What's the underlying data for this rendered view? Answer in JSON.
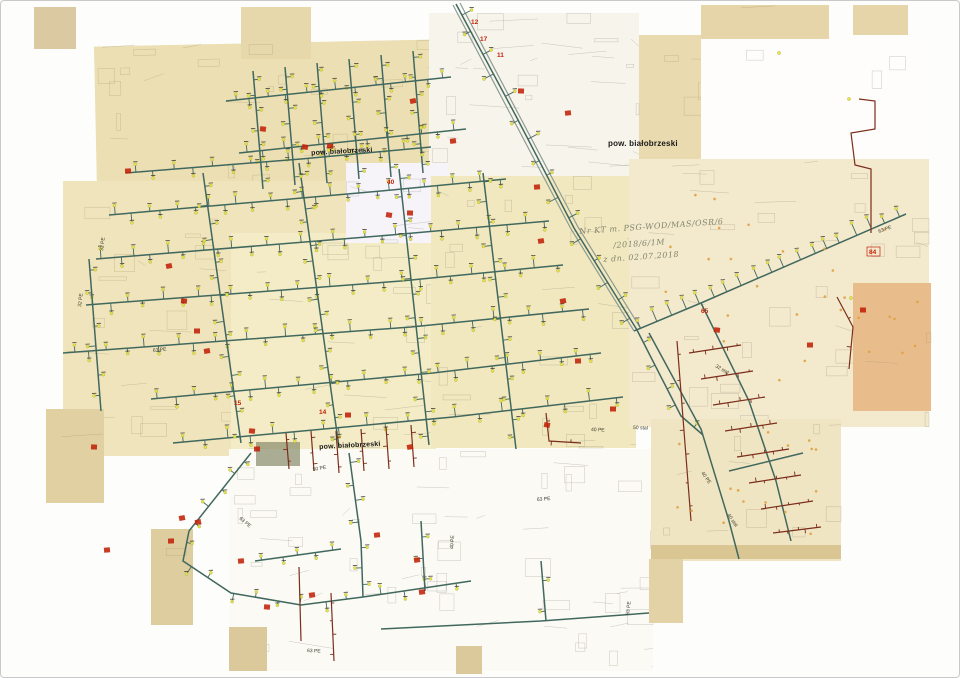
{
  "page": {
    "width": 960,
    "height": 678,
    "border_color": "#c9c9c9",
    "background": "#ffffff"
  },
  "palette": {
    "teal": "#41685e",
    "maroon": "#7b2e1c",
    "red": "#c22108",
    "yellow_dot": "#e8e348",
    "orange_dot": "#dfa13e",
    "road_casing": "#8d9b94",
    "handwriting": "#83856e",
    "print": "#191917",
    "pipe_label": "#3c3c2c"
  },
  "labels": {
    "pow1": {
      "text": "pow. białobrzeski",
      "x": 310,
      "y": 149,
      "fs": 7,
      "r": -3
    },
    "pow2": {
      "text": "pow. białobrzeski",
      "x": 607,
      "y": 138,
      "fs": 8,
      "r": 0
    },
    "pow3": {
      "text": "pow. białobrzeski",
      "x": 318,
      "y": 443,
      "fs": 7,
      "r": -3
    },
    "hw1": {
      "text": "Nr KT m. PSG-WOD/MAS/OSR/6",
      "x": 578,
      "y": 226,
      "fs": 8,
      "r": -4
    },
    "hw2": {
      "text": "/2018/6/1M",
      "x": 612,
      "y": 240,
      "fs": 8,
      "r": -4
    },
    "hw3": {
      "text": "z dn. 02.07.2018",
      "x": 602,
      "y": 254,
      "fs": 8,
      "r": -4
    }
  },
  "sheets": [
    {
      "x": 33,
      "y": 6,
      "w": 42,
      "h": 42,
      "c": "#dbc9a1",
      "dens": 0.4
    },
    {
      "x": 95,
      "y": 42,
      "w": 340,
      "h": 196,
      "c": "#ecdfb4",
      "rot": -1.2,
      "dens": 1
    },
    {
      "x": 240,
      "y": 6,
      "w": 70,
      "h": 52,
      "c": "#e7d8ac",
      "dens": 0.5
    },
    {
      "x": 620,
      "y": 34,
      "w": 90,
      "h": 145,
      "c": "#e9dab0",
      "dens": 0.8
    },
    {
      "x": 700,
      "y": 4,
      "w": 128,
      "h": 36,
      "c": "#e5d5a9",
      "dens": 0.4
    },
    {
      "x": 852,
      "y": 4,
      "w": 55,
      "h": 30,
      "c": "#e5d5a9",
      "dens": 0.3
    },
    {
      "x": 428,
      "y": 12,
      "w": 210,
      "h": 165,
      "c": "#f7f4ec",
      "dens": 2.4
    },
    {
      "x": 700,
      "y": 38,
      "w": 228,
      "h": 128,
      "c": "#fefdfb",
      "dens": 0.4
    },
    {
      "x": 62,
      "y": 180,
      "w": 300,
      "h": 275,
      "c": "#efe4bb",
      "dens": 1.1
    },
    {
      "x": 230,
      "y": 232,
      "w": 205,
      "h": 218,
      "c": "#f3ecc6",
      "dens": 1.2
    },
    {
      "x": 345,
      "y": 162,
      "w": 102,
      "h": 80,
      "c": "#f6f4f8",
      "dens": 1.8
    },
    {
      "x": 430,
      "y": 175,
      "w": 205,
      "h": 272,
      "c": "#f1e8bf",
      "dens": 1.2
    },
    {
      "x": 628,
      "y": 158,
      "w": 300,
      "h": 268,
      "c": "#f3e9cd",
      "dens": 1.1
    },
    {
      "x": 852,
      "y": 282,
      "w": 78,
      "h": 128,
      "c": "#e9bc8c",
      "dens": 0.6
    },
    {
      "x": 45,
      "y": 408,
      "w": 58,
      "h": 94,
      "c": "#e0d0a2",
      "dens": 0.4
    },
    {
      "x": 150,
      "y": 528,
      "w": 42,
      "h": 96,
      "c": "#decd9f",
      "dens": 0.4
    },
    {
      "x": 228,
      "y": 448,
      "w": 424,
      "h": 222,
      "c": "#fbfaf5",
      "dens": 1.5
    },
    {
      "x": 650,
      "y": 418,
      "w": 190,
      "h": 142,
      "c": "#f0e5c2",
      "dens": 1.2
    },
    {
      "x": 650,
      "y": 544,
      "w": 190,
      "h": 14,
      "c": "#d9c693",
      "dens": 0
    },
    {
      "x": 648,
      "y": 558,
      "w": 34,
      "h": 64,
      "c": "#e2d2a6",
      "dens": 0.3
    },
    {
      "x": 228,
      "y": 626,
      "w": 38,
      "h": 44,
      "c": "#dbc89b",
      "dens": 0.3
    },
    {
      "x": 455,
      "y": 645,
      "w": 26,
      "h": 28,
      "c": "#dbc89b",
      "dens": 0.2
    },
    {
      "x": 255,
      "y": 441,
      "w": 44,
      "h": 24,
      "c": "#8f9272",
      "op": 0.75,
      "dens": 0
    }
  ],
  "roads": [
    {
      "p": [
        [
          452,
          4
        ],
        [
          512,
          118
        ],
        [
          570,
          228
        ],
        [
          633,
          330
        ]
      ]
    },
    {
      "p": [
        [
          459,
          2
        ],
        [
          519,
          116
        ],
        [
          577,
          226
        ],
        [
          640,
          328
        ]
      ]
    }
  ],
  "pipes": [
    {
      "p": [
        [
          108,
          214
        ],
        [
          380,
          190
        ],
        [
          505,
          178
        ]
      ],
      "n": 26,
      "len": 7,
      "side": 0
    },
    {
      "p": [
        [
          95,
          258
        ],
        [
          390,
          234
        ],
        [
          548,
          220
        ]
      ],
      "n": 28,
      "len": 7,
      "side": 0
    },
    {
      "p": [
        [
          85,
          304
        ],
        [
          400,
          280
        ],
        [
          562,
          264
        ]
      ],
      "n": 28,
      "len": 7,
      "side": 0
    },
    {
      "p": [
        [
          62,
          352
        ],
        [
          410,
          326
        ],
        [
          588,
          308
        ]
      ],
      "n": 30,
      "len": 7,
      "side": 0
    },
    {
      "p": [
        [
          150,
          398
        ],
        [
          432,
          372
        ],
        [
          600,
          352
        ]
      ],
      "n": 26,
      "len": 7,
      "side": 0
    },
    {
      "p": [
        [
          172,
          442
        ],
        [
          452,
          416
        ],
        [
          622,
          396
        ]
      ],
      "n": 20,
      "len": 7,
      "side": 0
    },
    {
      "p": [
        [
          202,
          172
        ],
        [
          240,
          442
        ]
      ],
      "n": 14,
      "len": 6,
      "side": 0
    },
    {
      "p": [
        [
          298,
          162
        ],
        [
          338,
          446
        ]
      ],
      "n": 16,
      "len": 6,
      "side": 0
    },
    {
      "p": [
        [
          398,
          168
        ],
        [
          428,
          444
        ]
      ],
      "n": 14,
      "len": 6,
      "side": 0
    },
    {
      "p": [
        [
          482,
          172
        ],
        [
          515,
          448
        ]
      ],
      "n": 14,
      "len": 6,
      "side": 0
    },
    {
      "p": [
        [
          252,
          70
        ],
        [
          262,
          188
        ]
      ],
      "n": 7,
      "len": 5,
      "side": 0
    },
    {
      "p": [
        [
          284,
          66
        ],
        [
          294,
          184
        ]
      ],
      "n": 7,
      "len": 5,
      "side": 0
    },
    {
      "p": [
        [
          316,
          62
        ],
        [
          326,
          182
        ]
      ],
      "n": 7,
      "len": 5,
      "side": 0
    },
    {
      "p": [
        [
          348,
          58
        ],
        [
          358,
          178
        ]
      ],
      "n": 7,
      "len": 5,
      "side": 0
    },
    {
      "p": [
        [
          380,
          54
        ],
        [
          390,
          176
        ]
      ],
      "n": 7,
      "len": 5,
      "side": 0
    },
    {
      "p": [
        [
          412,
          50
        ],
        [
          422,
          172
        ]
      ],
      "n": 7,
      "len": 5,
      "side": 0
    },
    {
      "p": [
        [
          225,
          100
        ],
        [
          450,
          76
        ]
      ],
      "n": 13,
      "len": 6,
      "side": 0
    },
    {
      "p": [
        [
          238,
          152
        ],
        [
          465,
          128
        ]
      ],
      "n": 13,
      "len": 6,
      "side": 0
    },
    {
      "p": [
        [
          125,
          172
        ],
        [
          300,
          158
        ],
        [
          430,
          146
        ]
      ],
      "n": 16,
      "len": 6,
      "side": 0
    },
    {
      "p": [
        [
          633,
          330
        ],
        [
          700,
          302
        ],
        [
          905,
          213
        ]
      ],
      "n": 19,
      "len": 9,
      "side": -1
    },
    {
      "p": [
        [
          455,
          3
        ],
        [
          516,
          117
        ],
        [
          573,
          227
        ],
        [
          636,
          329
        ]
      ],
      "n": 16,
      "len": 8,
      "side": 0
    },
    {
      "p": [
        [
          636,
          329
        ],
        [
          680,
          415
        ],
        [
          702,
          434
        ]
      ],
      "n": 5,
      "len": 7,
      "side": 0
    },
    {
      "p": [
        [
          250,
          452
        ],
        [
          188,
          530
        ]
      ],
      "n": 5,
      "len": 6,
      "side": 0
    },
    {
      "p": [
        [
          188,
          530
        ],
        [
          182,
          560
        ],
        [
          230,
          592
        ],
        [
          300,
          604
        ],
        [
          362,
          596
        ]
      ],
      "n": 9,
      "len": 6,
      "side": 0
    },
    {
      "p": [
        [
          348,
          452
        ],
        [
          360,
          540
        ],
        [
          362,
          596
        ]
      ],
      "n": 7,
      "len": 6,
      "side": 0
    },
    {
      "p": [
        [
          362,
          596
        ],
        [
          470,
          580
        ]
      ],
      "n": 4,
      "len": 6,
      "side": 0
    },
    {
      "p": [
        [
          420,
          520
        ],
        [
          424,
          590
        ]
      ],
      "n": 3,
      "len": 5,
      "side": 0
    },
    {
      "p": [
        [
          254,
          560
        ],
        [
          340,
          548
        ]
      ],
      "n": 5,
      "len": 5,
      "side": 0
    },
    {
      "p": [
        [
          380,
          628
        ],
        [
          540,
          620
        ],
        [
          648,
          612
        ]
      ],
      "n": 0
    },
    {
      "p": [
        [
          540,
          560
        ],
        [
          545,
          620
        ]
      ],
      "n": 2,
      "len": 5,
      "side": 0
    },
    {
      "p": [
        [
          648,
          332
        ],
        [
          700,
          428
        ],
        [
          728,
          520
        ],
        [
          738,
          558
        ]
      ],
      "n": 0
    },
    {
      "p": [
        [
          700,
          302
        ],
        [
          748,
          400
        ],
        [
          775,
          480
        ],
        [
          790,
          540
        ]
      ],
      "n": 0
    },
    {
      "p": [
        [
          728,
          470
        ],
        [
          802,
          452
        ]
      ],
      "n": 0
    },
    {
      "p": [
        [
          88,
          258
        ],
        [
          100,
          410
        ]
      ],
      "n": 6,
      "len": 6,
      "side": 0
    },
    {
      "c": "maroon",
      "p": [
        [
          858,
          98
        ],
        [
          874,
          100
        ],
        [
          874,
          128
        ],
        [
          850,
          132
        ],
        [
          854,
          164
        ],
        [
          870,
          168
        ],
        [
          870,
          232
        ]
      ],
      "n": 0
    },
    {
      "c": "maroon",
      "p": [
        [
          688,
          352
        ],
        [
          740,
          344
        ]
      ],
      "n": 5,
      "len": 3,
      "side": 0,
      "dot": false
    },
    {
      "c": "maroon",
      "p": [
        [
          700,
          378
        ],
        [
          752,
          370
        ]
      ],
      "n": 5,
      "len": 3,
      "side": 0,
      "dot": false
    },
    {
      "c": "maroon",
      "p": [
        [
          712,
          404
        ],
        [
          764,
          396
        ]
      ],
      "n": 5,
      "len": 3,
      "side": 0,
      "dot": false
    },
    {
      "c": "maroon",
      "p": [
        [
          724,
          430
        ],
        [
          776,
          422
        ]
      ],
      "n": 5,
      "len": 3,
      "side": 0,
      "dot": false
    },
    {
      "c": "maroon",
      "p": [
        [
          736,
          456
        ],
        [
          788,
          448
        ]
      ],
      "n": 5,
      "len": 3,
      "side": 0,
      "dot": false
    },
    {
      "c": "maroon",
      "p": [
        [
          748,
          482
        ],
        [
          800,
          474
        ]
      ],
      "n": 5,
      "len": 3,
      "side": 0,
      "dot": false
    },
    {
      "c": "maroon",
      "p": [
        [
          760,
          508
        ],
        [
          812,
          500
        ]
      ],
      "n": 5,
      "len": 3,
      "side": 0,
      "dot": false
    },
    {
      "c": "maroon",
      "p": [
        [
          772,
          532
        ],
        [
          820,
          526
        ]
      ],
      "n": 5,
      "len": 3,
      "side": 0,
      "dot": false
    },
    {
      "c": "maroon",
      "p": [
        [
          676,
          340
        ],
        [
          690,
          520
        ]
      ],
      "n": 7,
      "len": 3,
      "side": 0,
      "dot": false
    },
    {
      "c": "maroon",
      "p": [
        [
          285,
          432
        ],
        [
          288,
          468
        ]
      ],
      "n": 3,
      "len": 3,
      "side": 0,
      "dot": false
    },
    {
      "c": "maroon",
      "p": [
        [
          310,
          430
        ],
        [
          313,
          470
        ]
      ],
      "n": 3,
      "len": 3,
      "side": 0,
      "dot": false
    },
    {
      "c": "maroon",
      "p": [
        [
          335,
          430
        ],
        [
          338,
          472
        ]
      ],
      "n": 3,
      "len": 3,
      "side": 0,
      "dot": false
    },
    {
      "c": "maroon",
      "p": [
        [
          360,
          428
        ],
        [
          363,
          470
        ]
      ],
      "n": 3,
      "len": 3,
      "side": 0,
      "dot": false
    },
    {
      "c": "maroon",
      "p": [
        [
          385,
          426
        ],
        [
          388,
          468
        ]
      ],
      "n": 3,
      "len": 3,
      "side": 0,
      "dot": false
    },
    {
      "c": "maroon",
      "p": [
        [
          410,
          424
        ],
        [
          413,
          466
        ]
      ],
      "n": 3,
      "len": 3,
      "side": 0,
      "dot": false
    },
    {
      "c": "maroon",
      "p": [
        [
          330,
          592
        ],
        [
          333,
          660
        ]
      ],
      "n": 4,
      "len": 3,
      "side": 0,
      "dot": false
    },
    {
      "c": "maroon",
      "p": [
        [
          298,
          566
        ],
        [
          300,
          640
        ]
      ],
      "n": 0
    },
    {
      "c": "maroon",
      "p": [
        [
          545,
          412
        ],
        [
          548,
          440
        ],
        [
          580,
          442
        ]
      ],
      "n": 3,
      "len": 3,
      "side": 0,
      "dot": false
    },
    {
      "c": "maroon",
      "p": [
        [
          836,
          296
        ],
        [
          852,
          326
        ],
        [
          848,
          368
        ]
      ],
      "n": 2,
      "len": 3,
      "side": 0,
      "dot": false
    }
  ],
  "red_text_markers": [
    {
      "t": "12",
      "x": 470,
      "y": 23
    },
    {
      "t": "17",
      "x": 479,
      "y": 40
    },
    {
      "t": "11",
      "x": 496,
      "y": 56
    },
    {
      "t": "65",
      "x": 700,
      "y": 312
    },
    {
      "t": "84",
      "x": 868,
      "y": 253,
      "box": true
    },
    {
      "t": "40",
      "x": 386,
      "y": 183
    },
    {
      "t": "15",
      "x": 233,
      "y": 404
    },
    {
      "t": "14",
      "x": 318,
      "y": 413
    }
  ],
  "red_blob_markers": [
    [
      127,
      170
    ],
    [
      168,
      265
    ],
    [
      183,
      300
    ],
    [
      196,
      330
    ],
    [
      206,
      350
    ],
    [
      262,
      128
    ],
    [
      304,
      146
    ],
    [
      329,
      145
    ],
    [
      412,
      100
    ],
    [
      452,
      140
    ],
    [
      388,
      214
    ],
    [
      409,
      212
    ],
    [
      347,
      414
    ],
    [
      251,
      430
    ],
    [
      256,
      448
    ],
    [
      409,
      446
    ],
    [
      540,
      240
    ],
    [
      562,
      300
    ],
    [
      577,
      360
    ],
    [
      612,
      408
    ],
    [
      546,
      424
    ],
    [
      197,
      521
    ],
    [
      106,
      549
    ],
    [
      376,
      534
    ],
    [
      416,
      559
    ],
    [
      421,
      591
    ],
    [
      311,
      594
    ],
    [
      181,
      517
    ],
    [
      716,
      329
    ],
    [
      809,
      344
    ],
    [
      862,
      309
    ],
    [
      93,
      446
    ],
    [
      536,
      186
    ],
    [
      567,
      112
    ],
    [
      520,
      90
    ],
    [
      240,
      560
    ],
    [
      266,
      606
    ],
    [
      170,
      540
    ]
  ],
  "orange_dot_regions": [
    {
      "x": 658,
      "y": 185,
      "w": 250,
      "h": 225,
      "n": 22
    },
    {
      "x": 655,
      "y": 430,
      "w": 175,
      "h": 108,
      "n": 16
    },
    {
      "x": 856,
      "y": 290,
      "w": 68,
      "h": 112,
      "n": 6
    }
  ],
  "yellow_dots": [
    [
      848,
      98
    ],
    [
      850,
      297
    ],
    [
      778,
      52
    ]
  ],
  "pipe_labels": [
    {
      "t": "63 PE",
      "x": 152,
      "y": 351,
      "r": -6
    },
    {
      "t": "32 PE",
      "x": 80,
      "y": 306,
      "r": -83
    },
    {
      "t": "50 PE",
      "x": 312,
      "y": 470,
      "r": -10
    },
    {
      "t": "63 PE",
      "x": 628,
      "y": 614,
      "r": -83
    },
    {
      "t": "63 PE",
      "x": 306,
      "y": 651,
      "r": 3
    },
    {
      "t": "40 PE",
      "x": 590,
      "y": 430,
      "r": 2
    },
    {
      "t": "50 stal",
      "x": 632,
      "y": 428,
      "r": 2
    },
    {
      "t": "32 stal",
      "x": 714,
      "y": 366,
      "r": 30
    },
    {
      "t": "40 PE",
      "x": 700,
      "y": 472,
      "r": 55
    },
    {
      "t": "40 stal",
      "x": 726,
      "y": 514,
      "r": 55
    },
    {
      "t": "63 PE",
      "x": 878,
      "y": 232,
      "r": -20
    },
    {
      "t": "63 PE",
      "x": 536,
      "y": 500,
      "r": -4
    },
    {
      "t": "40 PE",
      "x": 452,
      "y": 548,
      "r": -85
    },
    {
      "t": "63 PE",
      "x": 238,
      "y": 518,
      "r": 40
    },
    {
      "t": "32 PE",
      "x": 102,
      "y": 250,
      "r": -83
    }
  ]
}
